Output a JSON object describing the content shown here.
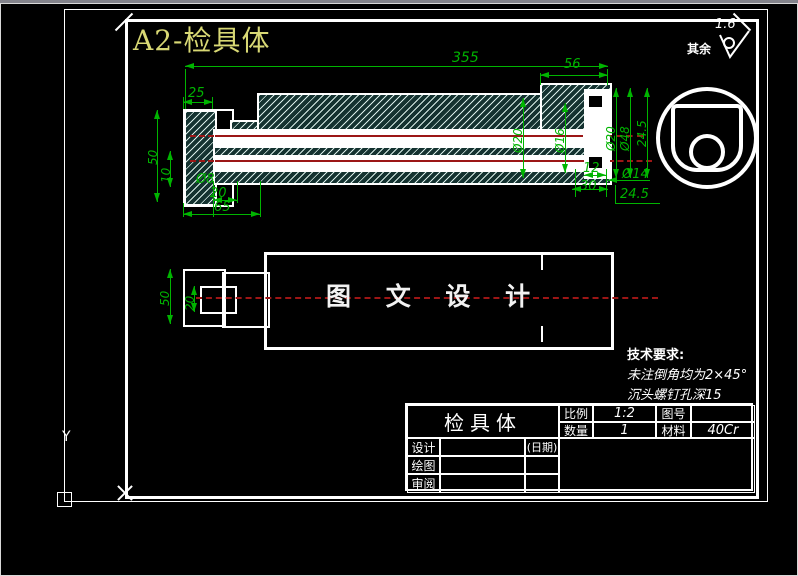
{
  "sheet": {
    "title": "A2-检具体"
  },
  "roughness": {
    "value": "1.6",
    "scope_label": "其余"
  },
  "section_view": {
    "dims": {
      "overall": "355",
      "seg56": "56",
      "seg25": "25",
      "h50": "50",
      "off10": "10",
      "dia8": "Ø8",
      "len20": "20",
      "len65": "65",
      "dia20a": "Ø20",
      "dia16": "Ø16",
      "dia20b": "Ø20",
      "dia48": "Ø48",
      "v245": "24.5",
      "len12": "12",
      "len30": "30",
      "dia14": "Ø14",
      "h245": "24.5"
    }
  },
  "plan_view": {
    "watermark": "图 文 设 计",
    "dims": {
      "h50": "50",
      "w20": "20"
    }
  },
  "tech_requirements": {
    "heading": "技术要求:",
    "line1": "未注倒角均为2×45°",
    "line2": "沉头螺钉孔深15"
  },
  "title_block": {
    "part_name": "检具体",
    "scale_label": "比例",
    "scale_value": "1:2",
    "drawing_no_label": "图号",
    "drawing_no_value": "",
    "qty_label": "数量",
    "qty_value": "1",
    "material_label": "材料",
    "material_value": "40Cr",
    "design_label": "设计",
    "draft_label": "绘图",
    "review_label": "审阅",
    "date_label": "(日期)"
  },
  "ucs": {
    "y_label": "Y"
  },
  "colors": {
    "dim-green": "#00b400",
    "center-red": "#9c1616",
    "title-yellow": "#d8d874",
    "line-white": "#ffffff"
  }
}
